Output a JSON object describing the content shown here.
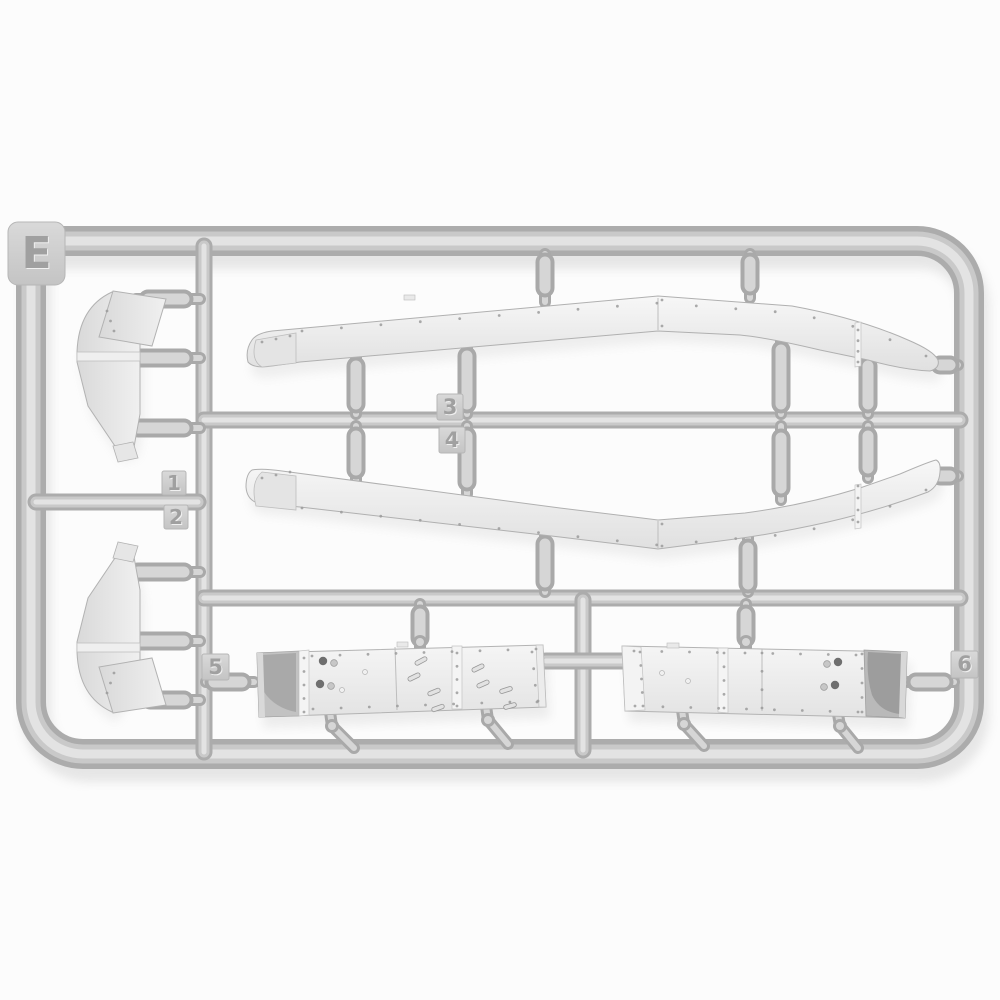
{
  "sprue": {
    "letter": "E",
    "tags": {
      "t1": "1",
      "t2": "2",
      "t3": "3",
      "t4": "4",
      "t5": "5",
      "t6": "6"
    },
    "colors": {
      "background": "#fcfcfc",
      "plastic_shadow": "#acacac",
      "plastic_base": "#c9c9c9",
      "plastic_highlight": "#e3e3e3",
      "gate_dark": "#a9a9a9",
      "gate_light": "#d6d6d6",
      "part_face_light": "#f6f6f6",
      "part_face_dark": "#e1e1e1",
      "rivet": "#9b9b9b",
      "cast_shadow": "#9a9a9a"
    }
  }
}
